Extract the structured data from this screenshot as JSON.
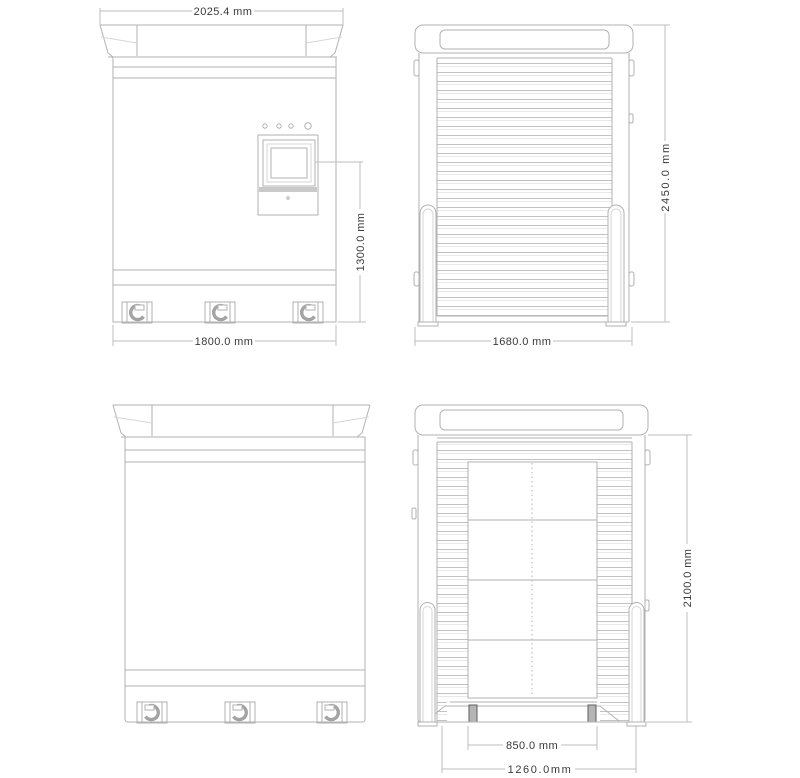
{
  "drawing": {
    "title": "cabinet four-view dimensional drawing",
    "units": "mm",
    "colors": {
      "line": "#b2b2b2",
      "line_light": "#d6d6d6",
      "text": "#3a3a3a",
      "panel_band": "#c9c9c9"
    },
    "views": {
      "front": {
        "label": "front view",
        "dims": {
          "top_width": "2025.4 mm",
          "screen_height": "1300.0 mm",
          "base_width": "1800.0 mm"
        }
      },
      "side_closed": {
        "label": "side view (shutter closed)",
        "dims": {
          "total_height": "2450.0 mm",
          "base_width": "1680.0 mm"
        }
      },
      "rear": {
        "label": "rear view",
        "dims": {}
      },
      "side_open": {
        "label": "side view (shutter open)",
        "dims": {
          "body_height": "2100.0 mm",
          "platform_width": "850.0 mm",
          "ramp_width": "1260.0mm"
        }
      }
    }
  }
}
